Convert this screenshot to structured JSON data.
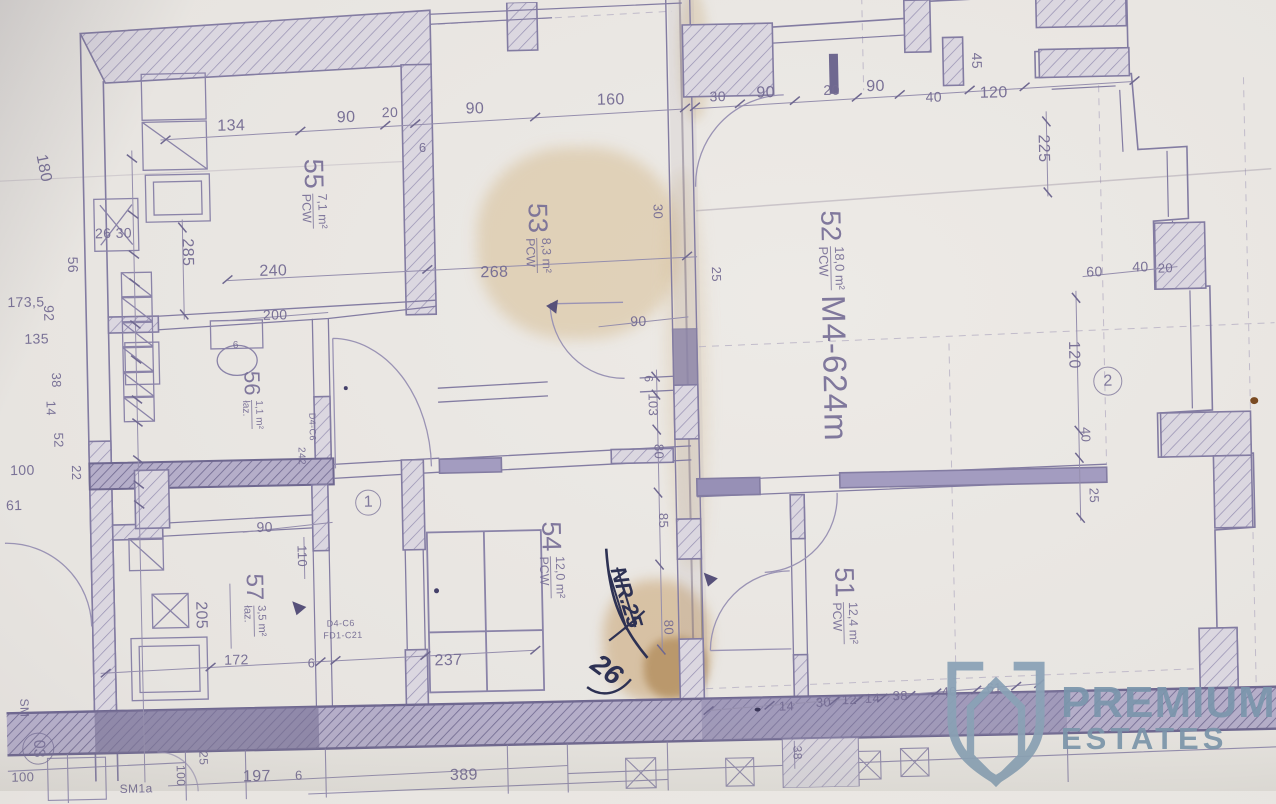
{
  "document_kind": "scanned architectural floor plan",
  "palette": {
    "paper": "#e8e5e1",
    "ink": "#8a83a8",
    "ink_dark": "#6f6890",
    "pencil": "#b7b0c4",
    "stain": "#c8a36e",
    "handwriting": "#2d3153",
    "watermark_blue": "#7b96ac",
    "band_green": "#d9dccb"
  },
  "watermark": {
    "line1": "PREMIUM",
    "line2": "ESTATES",
    "icon": "shield-hexagon-icon"
  },
  "handwriting": {
    "crossed_number": "NR.25",
    "new_number": "26"
  },
  "rooms": [
    {
      "number": "55",
      "area": "7,1 m²",
      "suffix": "PCW",
      "x": 318,
      "y": 187,
      "rot": 90,
      "size": 27
    },
    {
      "number": "53",
      "area": "8,3 m²",
      "suffix": "PCW",
      "x": 541,
      "y": 236,
      "rot": 90,
      "size": 27
    },
    {
      "number": "52",
      "area": "18,0 m²",
      "suffix": "PCW",
      "extra": "M4-624m",
      "x": 834,
      "y": 330,
      "rot": 90,
      "size": 28
    },
    {
      "number": "56",
      "area": "1,1 m²",
      "suffix": "łaz.",
      "x": 252,
      "y": 392,
      "rot": 90,
      "size": 22
    },
    {
      "number": "54",
      "area": "12,0 m²",
      "suffix": "PCW",
      "x": 548,
      "y": 558,
      "rot": 90,
      "size": 27
    },
    {
      "number": "51",
      "area": "12,4 m²",
      "suffix": "PCW",
      "x": 840,
      "y": 610,
      "rot": 90,
      "size": 27
    },
    {
      "number": "57",
      "area": "3,5 m²",
      "suffix": "łaz.",
      "x": 250,
      "y": 597,
      "rot": 90,
      "size": 24
    }
  ],
  "axis_markers": [
    {
      "t": "2",
      "x": 1108,
      "y": 391,
      "d": 27,
      "r": 0
    },
    {
      "t": "1",
      "x": 366,
      "y": 497,
      "d": 24,
      "r": 0
    },
    {
      "t": "03",
      "x": 31,
      "y": 736,
      "d": 30,
      "r": 90
    }
  ],
  "dimensions": [
    {
      "t": "134",
      "x": 237,
      "y": 118
    },
    {
      "t": "90",
      "x": 352,
      "y": 112
    },
    {
      "t": "20",
      "x": 396,
      "y": 107,
      "s": 14
    },
    {
      "t": "6",
      "x": 428,
      "y": 143,
      "s": 13
    },
    {
      "t": "90",
      "x": 481,
      "y": 106
    },
    {
      "t": "160",
      "x": 617,
      "y": 100
    },
    {
      "t": "30",
      "x": 724,
      "y": 98,
      "s": 14
    },
    {
      "t": "90",
      "x": 772,
      "y": 96
    },
    {
      "t": "20",
      "x": 838,
      "y": 94,
      "s": 14
    },
    {
      "t": "90",
      "x": 882,
      "y": 92
    },
    {
      "t": "40",
      "x": 940,
      "y": 103,
      "s": 14
    },
    {
      "t": "120",
      "x": 1000,
      "y": 101
    },
    {
      "t": "45",
      "x": 984,
      "y": 68,
      "r": 90,
      "s": 14
    },
    {
      "t": "225",
      "x": 1048,
      "y": 157,
      "r": 90
    },
    {
      "t": "60",
      "x": 1097,
      "y": 281,
      "s": 14
    },
    {
      "t": "40",
      "x": 1143,
      "y": 277,
      "s": 14
    },
    {
      "t": "20",
      "x": 1168,
      "y": 279,
      "s": 13
    },
    {
      "t": "120",
      "x": 1074,
      "y": 364,
      "r": 90
    },
    {
      "t": "40",
      "x": 1085,
      "y": 444,
      "r": 90,
      "s": 13
    },
    {
      "t": "25",
      "x": 1092,
      "y": 505,
      "r": 90,
      "s": 13
    },
    {
      "t": "180",
      "x": 48,
      "y": 156,
      "r": 80
    },
    {
      "t": "26 30",
      "x": 117,
      "y": 222,
      "s": 14
    },
    {
      "t": "56",
      "x": 76,
      "y": 253,
      "r": 90,
      "s": 14
    },
    {
      "t": "173,5",
      "x": 28,
      "y": 289,
      "s": 14
    },
    {
      "t": "92",
      "x": 51,
      "y": 301,
      "r": 90,
      "s": 14
    },
    {
      "t": "135",
      "x": 38,
      "y": 326,
      "s": 14
    },
    {
      "t": "38",
      "x": 57,
      "y": 368,
      "r": 90,
      "s": 13
    },
    {
      "t": "14",
      "x": 51,
      "y": 396,
      "r": 90,
      "s": 13
    },
    {
      "t": "52",
      "x": 58,
      "y": 428,
      "r": 90,
      "s": 13
    },
    {
      "t": "100",
      "x": 21,
      "y": 457,
      "s": 14
    },
    {
      "t": "22",
      "x": 75,
      "y": 461,
      "r": 90,
      "s": 13
    },
    {
      "t": "61",
      "x": 12,
      "y": 492,
      "s": 14
    },
    {
      "t": "285",
      "x": 190,
      "y": 243,
      "r": 90
    },
    {
      "t": "240",
      "x": 276,
      "y": 264
    },
    {
      "t": "200",
      "x": 277,
      "y": 307,
      "s": 14
    },
    {
      "t": "268",
      "x": 497,
      "y": 270
    },
    {
      "t": "25",
      "x": 719,
      "y": 276,
      "r": 90,
      "s": 13
    },
    {
      "t": "30",
      "x": 662,
      "y": 212,
      "r": 90,
      "s": 13
    },
    {
      "t": "90",
      "x": 640,
      "y": 321,
      "s": 14
    },
    {
      "t": "6",
      "x": 649,
      "y": 379,
      "r": 90,
      "s": 12
    },
    {
      "t": "103",
      "x": 653,
      "y": 405,
      "r": 90,
      "s": 13
    },
    {
      "t": "80",
      "x": 658,
      "y": 452,
      "r": 90,
      "s": 13
    },
    {
      "t": "85",
      "x": 661,
      "y": 521,
      "r": 90,
      "s": 13
    },
    {
      "t": "80",
      "x": 664,
      "y": 628,
      "r": 90,
      "s": 13
    },
    {
      "t": "90",
      "x": 262,
      "y": 519,
      "s": 14
    },
    {
      "t": "110",
      "x": 299,
      "y": 549,
      "r": 90,
      "s": 13
    },
    {
      "t": "205",
      "x": 196,
      "y": 606,
      "r": 90
    },
    {
      "t": "172",
      "x": 231,
      "y": 651,
      "s": 14
    },
    {
      "t": "6",
      "x": 306,
      "y": 656,
      "s": 13
    },
    {
      "t": "237",
      "x": 443,
      "y": 657
    },
    {
      "t": "6",
      "x": 237,
      "y": 337,
      "s": 10
    },
    {
      "t": "D4-C6",
      "x": 312,
      "y": 420,
      "r": 90,
      "s": 9,
      "n": "door-code-label"
    },
    {
      "t": "242",
      "x": 300,
      "y": 449,
      "r": 90,
      "s": 10
    },
    {
      "t": "D4-C6",
      "x": 336,
      "y": 617,
      "s": 9,
      "n": "door-code-label"
    },
    {
      "t": "FD1-C21",
      "x": 338,
      "y": 629,
      "s": 9,
      "n": "door-code-label"
    },
    {
      "t": "14",
      "x": 780,
      "y": 709,
      "s": 13
    },
    {
      "t": "30",
      "x": 817,
      "y": 706,
      "s": 13
    },
    {
      "t": "12",
      "x": 843,
      "y": 704,
      "s": 13
    },
    {
      "t": "14",
      "x": 866,
      "y": 703,
      "s": 13
    },
    {
      "t": "38",
      "x": 894,
      "y": 701,
      "s": 13
    },
    {
      "t": "40",
      "x": 943,
      "y": 698,
      "s": 13
    },
    {
      "t": "61",
      "x": 988,
      "y": 695,
      "s": 13
    },
    {
      "t": "38",
      "x": 790,
      "y": 756,
      "r": 90,
      "s": 12
    },
    {
      "t": "25",
      "x": 196,
      "y": 749,
      "r": 90,
      "s": 12
    },
    {
      "t": "100",
      "x": 173,
      "y": 766,
      "r": 90,
      "s": 12
    },
    {
      "t": "197",
      "x": 249,
      "y": 769
    },
    {
      "t": "6",
      "x": 291,
      "y": 768,
      "s": 13
    },
    {
      "t": "389",
      "x": 456,
      "y": 772
    },
    {
      "t": "100",
      "x": 15,
      "y": 764,
      "s": 13
    },
    {
      "t": "SM1a",
      "x": 128,
      "y": 778,
      "s": 12,
      "n": "plan-code-label"
    },
    {
      "t": "SM",
      "x": 18,
      "y": 695,
      "r": 90,
      "s": 12,
      "n": "plan-code-label"
    }
  ]
}
